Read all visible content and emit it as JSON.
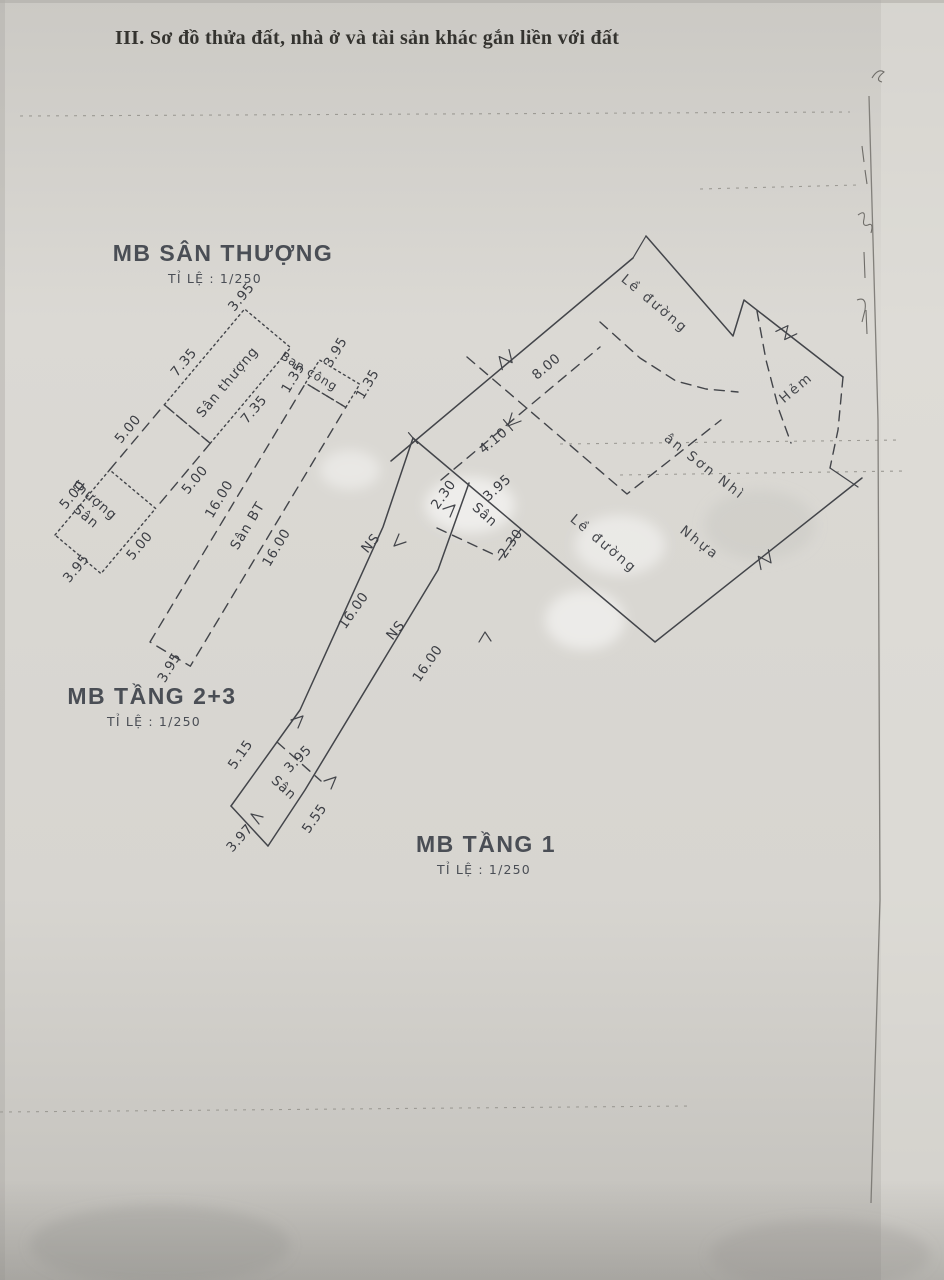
{
  "header": {
    "title": "III. Sơ đồ thửa đất, nhà ở và tài sản khác gắn liền với đất"
  },
  "colors": {
    "ink": "#43454a",
    "paper": "#d8d6d1"
  },
  "plans": {
    "roof": {
      "title": "MB SÂN THƯỢNG",
      "scale": "TỈ LỆ : 1/250",
      "room_small": {
        "line1": "Sân",
        "line2": "thượng"
      },
      "room_large": "Sân thượng",
      "dims": {
        "end_sw": "3.95",
        "a_nw": "5.00",
        "a_se": "5.00",
        "b_nw": "5.00",
        "b_se": "5.00",
        "c_nw": "7.35",
        "c_se": "7.35",
        "end_ne": "3.95"
      }
    },
    "floor23": {
      "title": "MB TẦNG 2+3",
      "scale": "TỈ LỆ : 1/250",
      "yard": "Sân BT",
      "balcony": "Ban công",
      "dims": {
        "end_sw": "3.95",
        "nw": "16.00",
        "se": "16.00",
        "bal_nw": "1.35",
        "bal_se": "1.35",
        "bal_end": "3.95"
      }
    },
    "floor1": {
      "title": "MB TẦNG 1",
      "scale": "TỈ LỆ : 1/250",
      "labels": {
        "yard_top": "Sân",
        "yard_bottom": "Sân",
        "ns_nw": "NS",
        "ns_se": "NS"
      },
      "dims": {
        "top_sidewalk": "4.10",
        "top_nw": "2.30",
        "top_face": "3.95",
        "top_se": "2.30",
        "nw": "16.00",
        "se": "16.00",
        "bottom_nw": "5.15",
        "bottom_divider": "3.95",
        "bottom_se": "5.55",
        "bottom_face": "3.97",
        "road": "8.00"
      },
      "streets": {
        "sidewalk_1": "Lề đường",
        "sidewalk_2": "Lề đường",
        "alley": "Hẻm",
        "surface": "Nhựa",
        "street_name": "ân Sơn Nhì"
      }
    }
  }
}
